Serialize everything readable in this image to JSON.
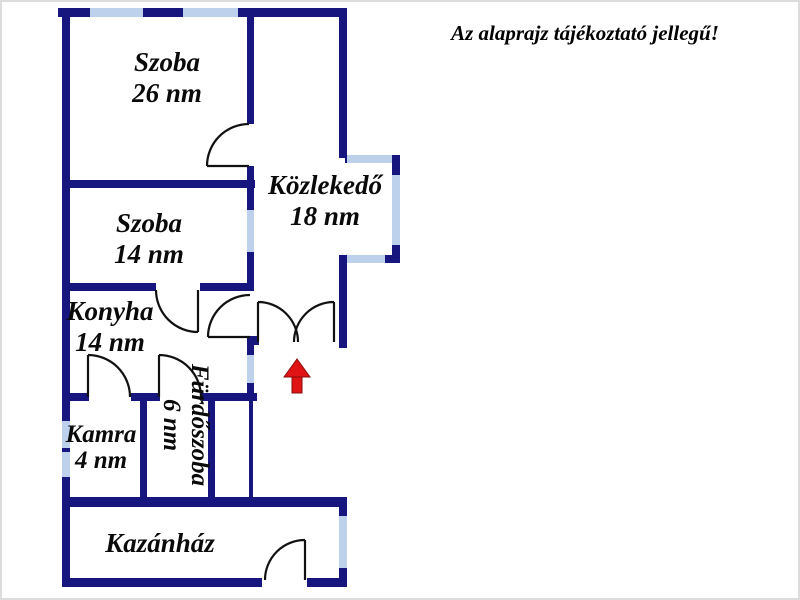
{
  "title": "Az alaprajz tájékoztató jellegű!",
  "rooms": {
    "szoba26": {
      "name": "Szoba",
      "area": "26 nm"
    },
    "szoba14": {
      "name": "Szoba",
      "area": "14 nm"
    },
    "kozlekedo": {
      "name": "Közlekedő",
      "area": "18 nm"
    },
    "konyha": {
      "name": "Konyha",
      "area": "14 nm"
    },
    "kamra": {
      "name": "Kamra",
      "area": "4 nm"
    },
    "furdoszoba": {
      "name": "Fürdőszoba",
      "area": "6 nm"
    },
    "kazanhaz": {
      "name": "Kazánház"
    }
  },
  "entrance": {
    "marker": "up-arrow"
  },
  "colors": {
    "wall": "#16167e",
    "window": "#bdd1ec",
    "door": "#111111",
    "entrance_arrow": "#e01414"
  }
}
